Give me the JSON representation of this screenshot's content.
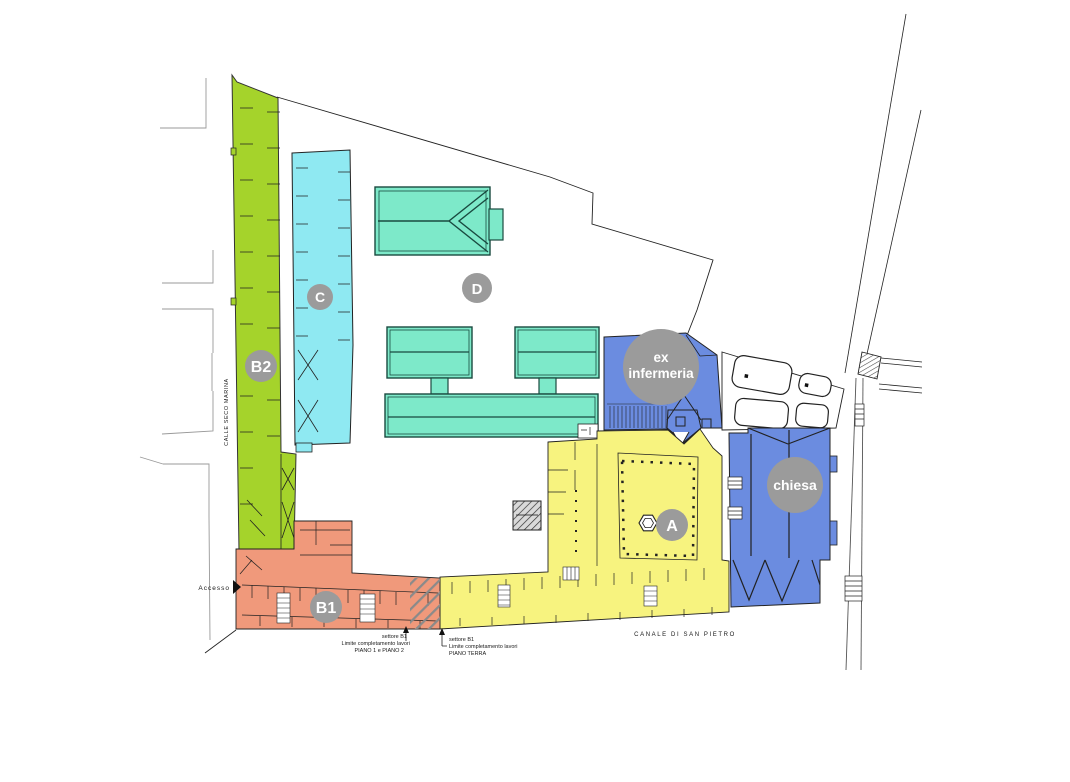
{
  "plan_title": "Site plan with sector zones",
  "zones": {
    "b2": {
      "label": "B2"
    },
    "c": {
      "label": "C"
    },
    "d": {
      "label": "D"
    },
    "a": {
      "label": "A"
    },
    "b1": {
      "label": "B1"
    },
    "ex_infermeria": {
      "label_line1": "ex",
      "label_line2": "infermeria"
    },
    "chiesa": {
      "label": "chiesa"
    }
  },
  "streets": {
    "calle": "CALLE SECO MARINA",
    "canale": "CANALE DI SAN PIETRO",
    "accesso": "Accesso"
  },
  "annotations": {
    "a1": {
      "line1": "settore B1",
      "line2": "Limite completamento lavori",
      "line3": "PIANO 1 e PIANO 2"
    },
    "a2": {
      "line1": "settore B1",
      "line2": "Limite completamento lavori",
      "line3": "PIANO TERRA"
    }
  },
  "colors": {
    "green_b2": "#a5d32b",
    "cyan_c": "#8fe9f2",
    "aqua_d": "#7de9c9",
    "blue_buildings": "#6b8ce0",
    "yellow_a": "#f7f37f",
    "salmon_b1": "#f0997b",
    "circle_gray": "#9b9b9b",
    "line_dark": "#222222",
    "line_street": "#999999"
  }
}
